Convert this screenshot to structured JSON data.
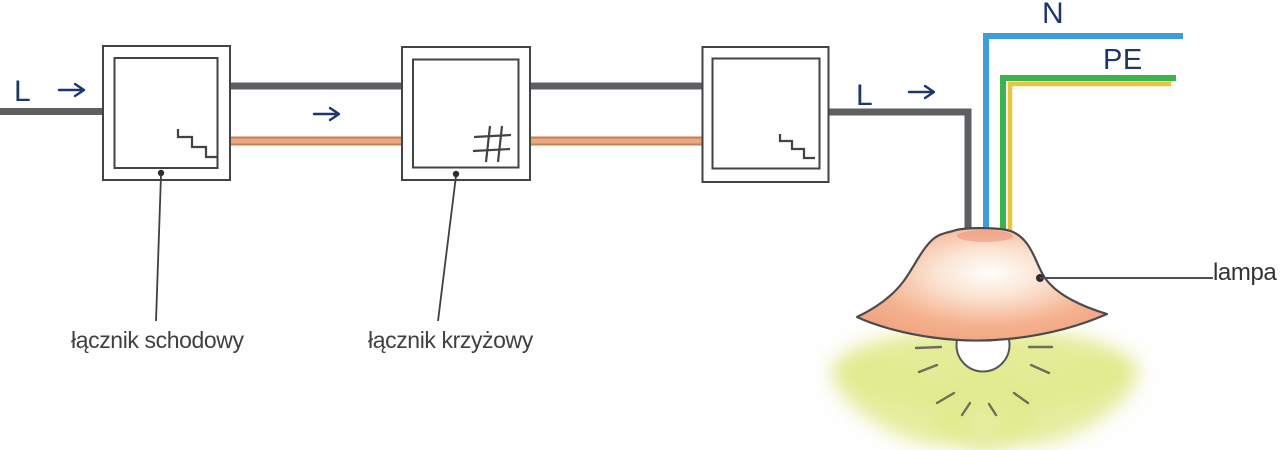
{
  "labels": {
    "l_left": "L",
    "l_right": "L",
    "n": "N",
    "pe": "PE",
    "staircase_switch": "łącznik schodowy",
    "cross_switch": "łącznik krzyżowy",
    "lamp": "lampa"
  },
  "colors": {
    "phase_wire_gray": "#5e5f62",
    "switched_wire_orange_edge": "#c57e58",
    "switched_wire_orange_core": "#eba77f",
    "neutral_wire_blue": "#3b9ed9",
    "earth_wire_green": "#3cb44b",
    "earth_wire_yellow": "#eac33f",
    "arrow_navy": "#1d3768",
    "outline_gray": "#434347",
    "lamp_glow": "#e2ea8d",
    "lamp_shade_edge": "#ee9b78"
  },
  "icons": {
    "switch1": "staircase-switch-icon",
    "switch2": "cross-switch-icon",
    "switch3": "staircase-switch-icon"
  }
}
